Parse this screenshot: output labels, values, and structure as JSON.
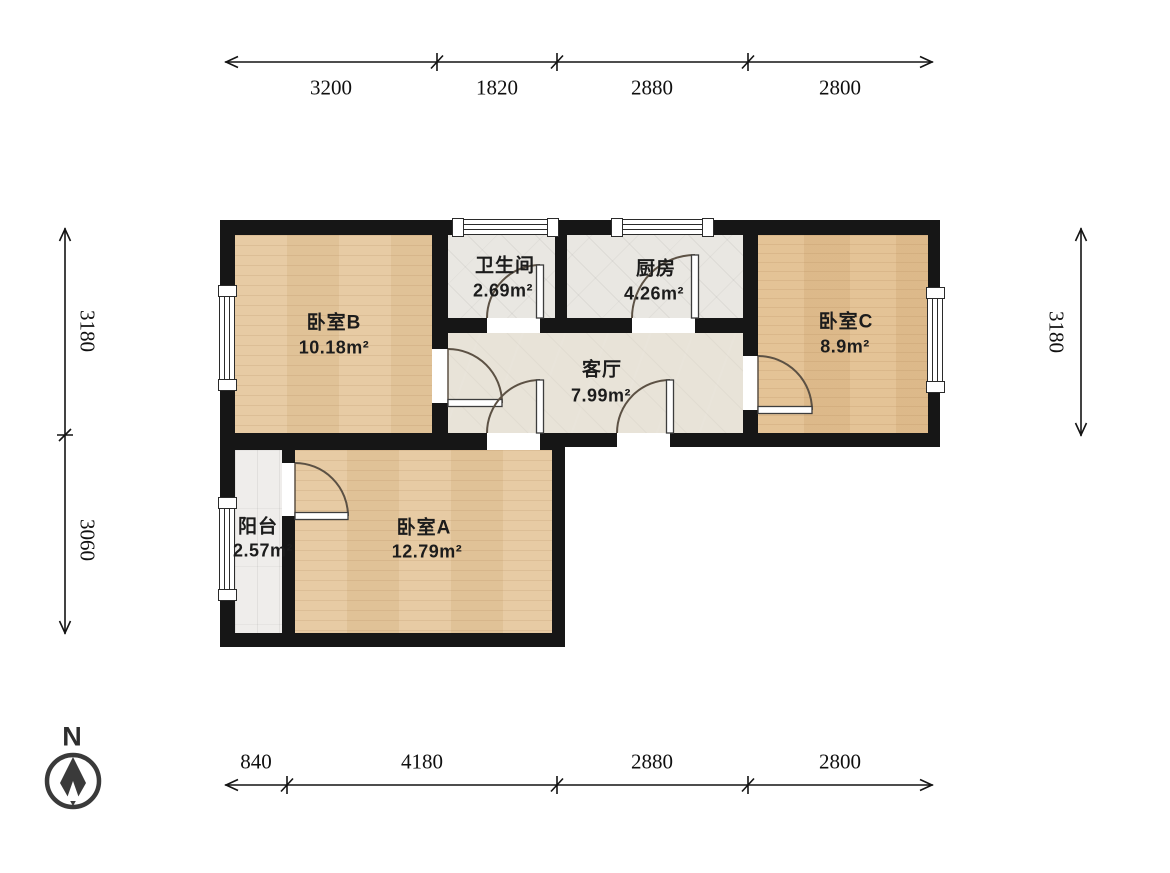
{
  "compass": {
    "label": "N"
  },
  "rooms": [
    {
      "key": "bedroom-b",
      "name": "卧室B",
      "area": "10.18m²"
    },
    {
      "key": "bathroom",
      "name": "卫生间",
      "area": "2.69m²"
    },
    {
      "key": "kitchen",
      "name": "厨房",
      "area": "4.26m²"
    },
    {
      "key": "bedroom-c",
      "name": "卧室C",
      "area": "8.9m²"
    },
    {
      "key": "living-room",
      "name": "客厅",
      "area": "7.99m²"
    },
    {
      "key": "balcony",
      "name": "阳台",
      "area": "2.57m²"
    },
    {
      "key": "bedroom-a",
      "name": "卧室A",
      "area": "12.79m²"
    }
  ],
  "dimensions": {
    "top": [
      "3200",
      "1820",
      "2880",
      "2800"
    ],
    "bottom": [
      "840",
      "4180",
      "2880",
      "2800"
    ],
    "left": [
      "3180",
      "3060"
    ],
    "right": [
      "3180"
    ]
  },
  "colors": {
    "wall": "#161616",
    "wood_floor": "#e6c89e",
    "wood_floor_dark": "#e2bf90",
    "tile_floor": "#e9e7e2",
    "living_floor": "#e8e3d8",
    "balcony_floor": "#efedeb",
    "dimension_line": "#141414"
  }
}
